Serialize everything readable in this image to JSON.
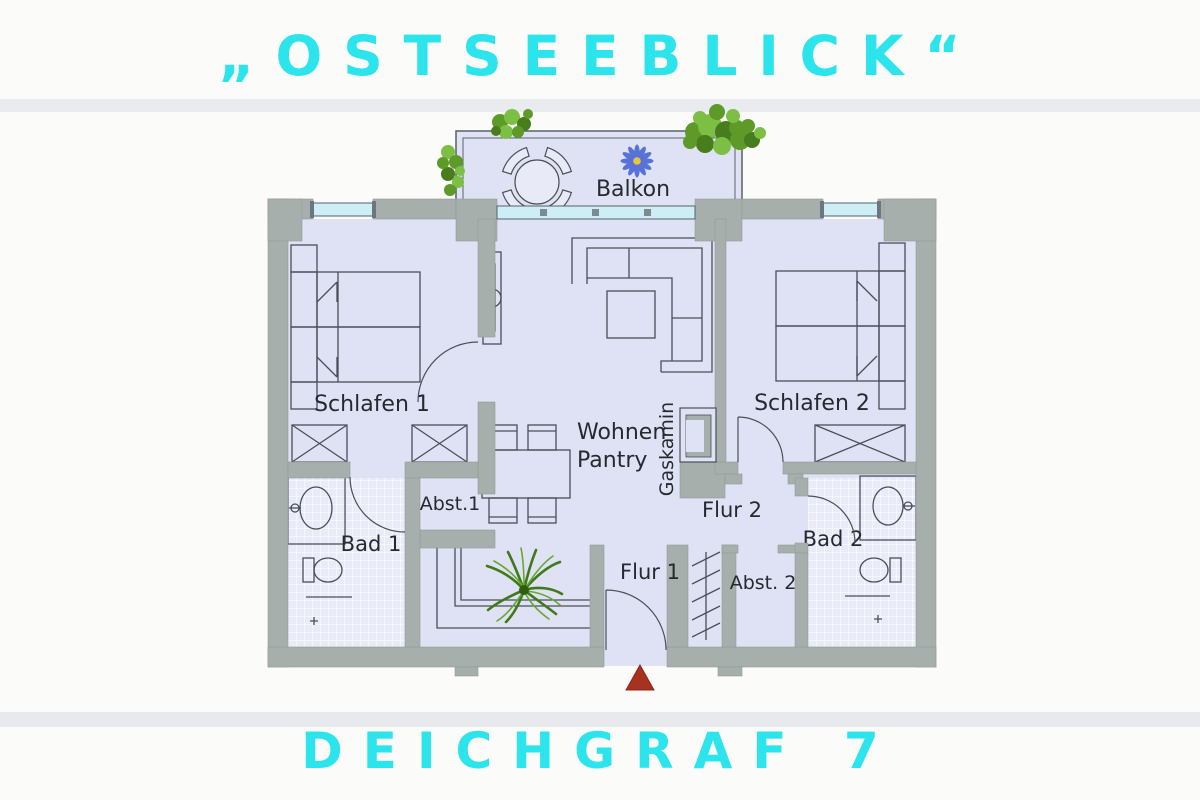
{
  "titles": {
    "top": "„OSTSEEBLICK“",
    "bottom": "DEICHGRAF 7"
  },
  "rooms": {
    "balkon": "Balkon",
    "schlafen1": "Schlafen 1",
    "schlafen2": "Schlafen 2",
    "wohnen": "Wohnen",
    "pantry": "Pantry",
    "gaskamin": "Gaskamin",
    "bad1": "Bad 1",
    "bad2": "Bad 2",
    "abst1": "Abst.1",
    "abst2": "Abst. 2",
    "flur1": "Flur 1",
    "flur2": "Flur 2"
  },
  "colors": {
    "accent_cyan": "#2be4ec",
    "wall_gray": "#a6afab",
    "floor_lavender": "#dfe2f4",
    "tile_light": "#e9ecf8",
    "window_glass": "#cdeef5",
    "entrance_marker_red": "#a83220",
    "plant_green_dark": "#477d1d",
    "plant_green_light": "#7cbf44",
    "flower_blue": "#5872d8",
    "flower_center_yellow": "#e8c63c"
  }
}
